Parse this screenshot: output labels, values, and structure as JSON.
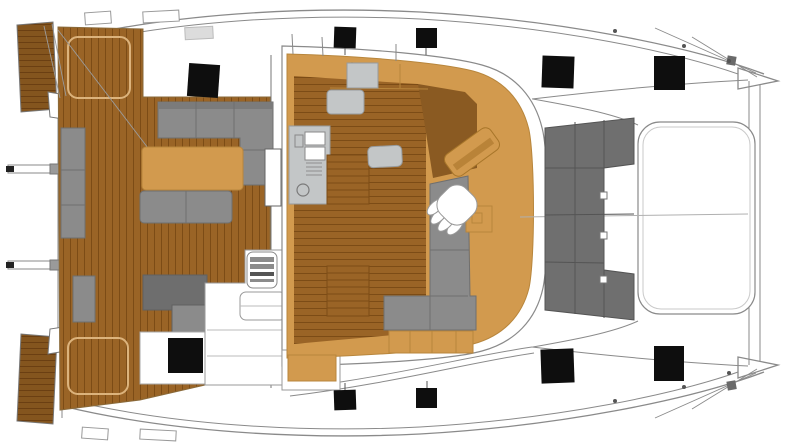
{
  "meta": {
    "description": "Catamaran saloon and deck layout plan, top-down view, bow to the right"
  },
  "palette": {
    "background": "#ffffff",
    "line": "#8a8a8a",
    "line_light": "#c9c9c9",
    "line_dark": "#555555",
    "teak": "#9a6426",
    "teak_line": "#7c4c16",
    "teak_edge": "#8a6a3a",
    "teak_dark": "#84551e",
    "teak_dark_line": "#6b3f12",
    "locker_outline": "#dcb37c",
    "tan": "#d29a4e",
    "tan_line": "#b8863c",
    "tan_dark": "#b98338",
    "wood_dark": "#8a5a22",
    "sofa": "#8b8b8b",
    "sofa_line": "#6f6f6f",
    "sofa_dark": "#6e6e6e",
    "fwd_sofa": "#6f6f6f",
    "fwd_sofa_line": "#545454",
    "counter": "#c3c6c7",
    "counter_line": "#979b9e",
    "white": "#ffffff",
    "hatch": "#0e0e0e",
    "metal": "#9a9a9a",
    "dark": "#222222",
    "dot": "#555555",
    "step_strip": "#dcdcdc"
  },
  "hatches": [
    {
      "x": 188,
      "y": 64,
      "w": 31,
      "h": 33,
      "rot": 4
    },
    {
      "x": 334,
      "y": 27,
      "w": 22,
      "h": 21,
      "rot": 2
    },
    {
      "x": 416,
      "y": 28,
      "w": 21,
      "h": 20,
      "rot": 0
    },
    {
      "x": 542,
      "y": 56,
      "w": 32,
      "h": 32,
      "rot": 2
    },
    {
      "x": 654,
      "y": 56,
      "w": 31,
      "h": 34,
      "rot": 0
    },
    {
      "x": 168,
      "y": 338,
      "w": 35,
      "h": 35,
      "rot": 0
    },
    {
      "x": 334,
      "y": 390,
      "w": 22,
      "h": 20,
      "rot": -2
    },
    {
      "x": 416,
      "y": 388,
      "w": 21,
      "h": 20,
      "rot": 0
    },
    {
      "x": 541,
      "y": 349,
      "w": 33,
      "h": 34,
      "rot": -2
    },
    {
      "x": 654,
      "y": 346,
      "w": 30,
      "h": 35,
      "rot": 0
    }
  ],
  "deck_dots": [
    {
      "x": 615,
      "y": 31
    },
    {
      "x": 684,
      "y": 46
    },
    {
      "x": 729,
      "y": 61
    },
    {
      "x": 615,
      "y": 401
    },
    {
      "x": 684,
      "y": 387
    },
    {
      "x": 729,
      "y": 373
    }
  ],
  "davit_arms": [
    {
      "y": 165
    },
    {
      "y": 261
    }
  ]
}
